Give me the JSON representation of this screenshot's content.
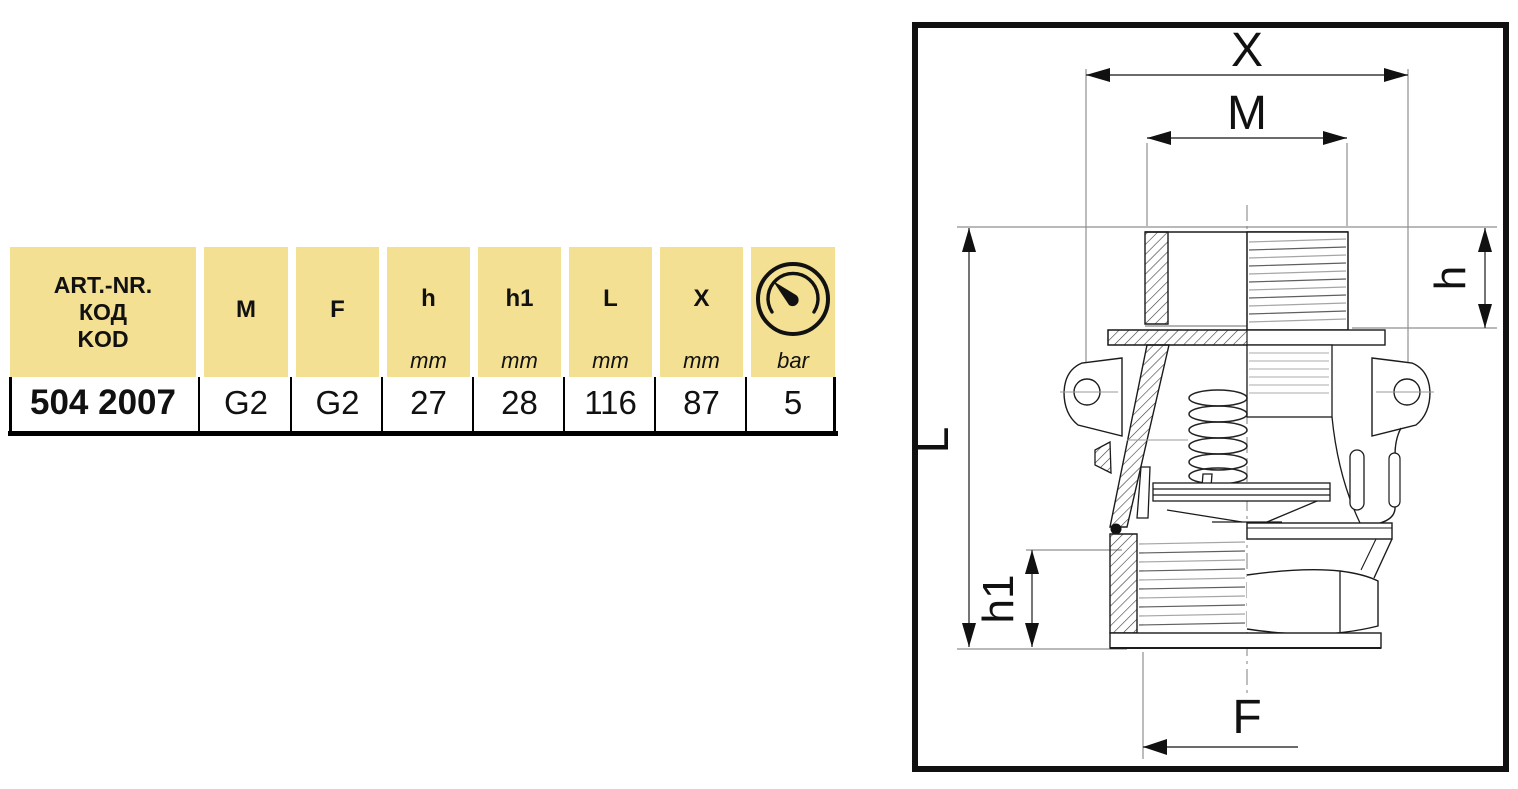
{
  "table": {
    "art_header_lines": [
      "ART.-NR.",
      "КОД",
      "KOD"
    ],
    "columns": [
      {
        "label": "M",
        "unit": ""
      },
      {
        "label": "F",
        "unit": ""
      },
      {
        "label": "h",
        "unit": "mm"
      },
      {
        "label": "h1",
        "unit": "mm"
      },
      {
        "label": "L",
        "unit": "mm"
      },
      {
        "label": "X",
        "unit": "mm"
      },
      {
        "label": "",
        "unit": "bar",
        "icon": "pressure-gauge"
      }
    ],
    "row": {
      "art_nr": "504 2007",
      "m": "G2",
      "f": "G2",
      "h": "27",
      "h1": "28",
      "l": "116",
      "x": "87",
      "bar": "5"
    }
  },
  "diagram": {
    "labels": {
      "x": "X",
      "m": "M",
      "h": "h",
      "l": "L",
      "h1": "h1",
      "f": "F"
    }
  },
  "colors": {
    "header_bg": "#F3E092",
    "line": "#111111",
    "ext_line": "#8f8f8f"
  }
}
